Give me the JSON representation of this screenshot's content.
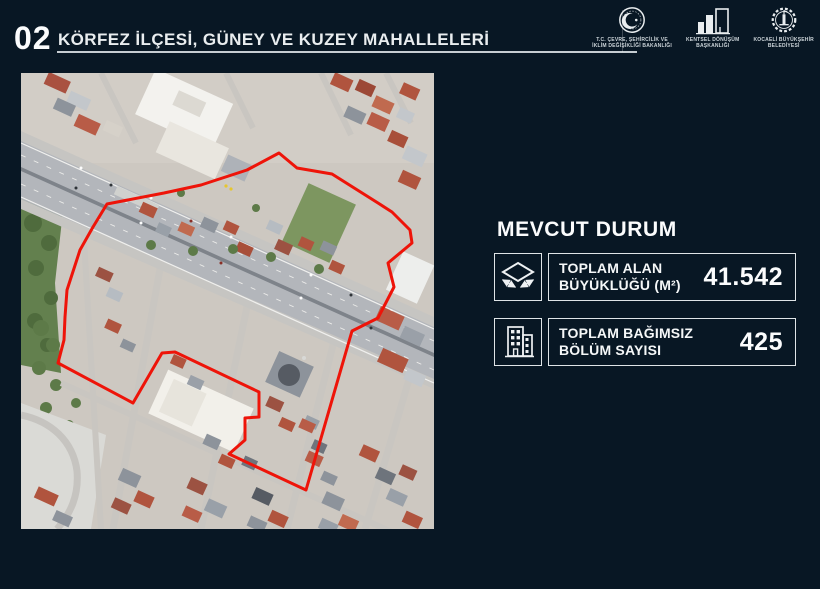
{
  "slide": {
    "number": "02",
    "title": "KÖRFEZ İLÇESİ, GÜNEY VE KUZEY MAHALLELERİ"
  },
  "colors": {
    "background": "#081724",
    "boundary_red": "#ee1409",
    "underline": "#c6cdd2"
  },
  "logos": [
    {
      "id": "cevre-sehircilik-bakanligi",
      "icon": "ministry-emblem-icon",
      "caption": [
        "T.C. ÇEVRE, ŞEHİRCİLİK VE",
        "İKLİM DEĞİŞİKLİĞİ BAKANLIĞI"
      ]
    },
    {
      "id": "kentsel-donusum-baskanligi",
      "icon": "city-buildings-icon",
      "caption": [
        "KENTSEL DÖNÜŞÜM",
        "BAŞKANLIĞI"
      ]
    },
    {
      "id": "kocaeli-buyuksehir-belediyesi",
      "icon": "gear-tower-emblem-icon",
      "caption": [
        "KOCAELİ BÜYÜKŞEHİR",
        "BELEDİYESİ"
      ]
    }
  ],
  "map": {
    "type": "satellite-aerial-photo",
    "boundary": "red project-area outline"
  },
  "panel": {
    "heading": "MEVCUT DURUM",
    "stats": [
      {
        "icon": "area-measure-icon",
        "label_line1": "TOPLAM ALAN",
        "label_line2": "BÜYÜKLÜĞÜ (M²)",
        "value": "41.542"
      },
      {
        "icon": "apartment-building-icon",
        "label_line1": "TOPLAM BAĞIMSIZ",
        "label_line2": "BÖLÜM SAYISI",
        "value": "425"
      }
    ]
  }
}
